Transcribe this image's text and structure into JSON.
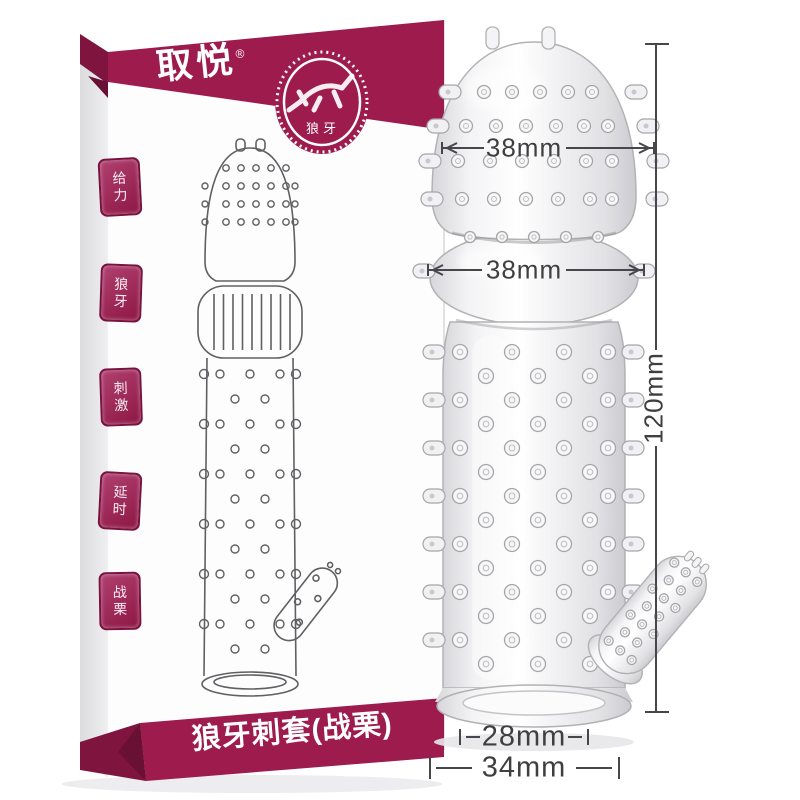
{
  "box": {
    "brand": "取悦",
    "registered_mark": "®",
    "stamp_label": "狼牙",
    "seals": [
      {
        "label": "给力"
      },
      {
        "label": "狼牙"
      },
      {
        "label": "刺激"
      },
      {
        "label": "延时"
      },
      {
        "label": "战栗"
      }
    ],
    "bottom_banner": "狼牙刺套(战栗)"
  },
  "dimensions": {
    "head_width": "38mm",
    "bulge_width": "38mm",
    "total_length": "120mm",
    "inner_diameter": "28mm",
    "base_outer_diameter": "34mm"
  },
  "colors": {
    "banner": "#9e1b4d",
    "banner_dark": "#7f153e",
    "banner_notch": "#691134",
    "box_side": "#e7e7ea",
    "box_front": "#fdfdfd",
    "annotation": "#3f3f42",
    "background": "#ffffff"
  }
}
